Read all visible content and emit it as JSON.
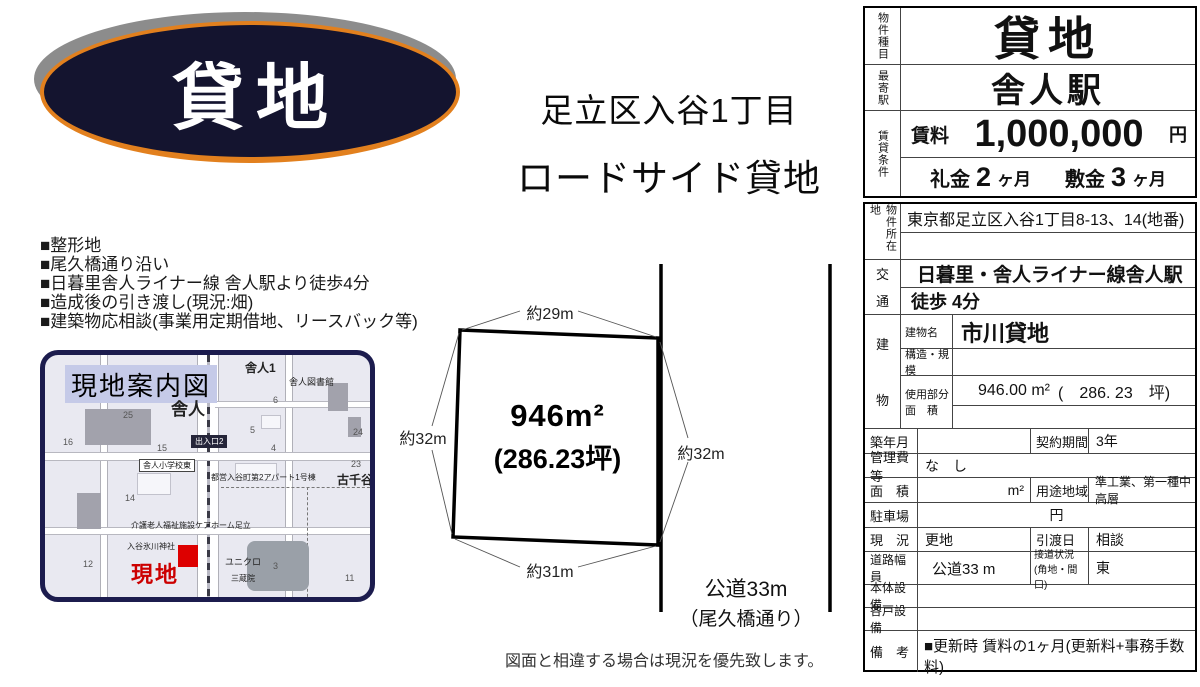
{
  "badge": {
    "label": "貸地"
  },
  "headline": {
    "line1": "足立区入谷1丁目",
    "line2": "ロードサイド貸地"
  },
  "features": [
    "■整形地",
    "■尾久橋通り沿い",
    "■日暮里舎人ライナー線 舎人駅より徒歩4分",
    "■造成後の引き渡し(現況:畑)",
    "■建築物応相談(事業用定期借地、リースバック等)"
  ],
  "map": {
    "title": "現地案内図",
    "site_label": "現地",
    "labels": {
      "town1": "舎人1",
      "library": "舎人図書館",
      "station": "舎人",
      "exit": "出入口2",
      "school_crossing": "舎人小学校東",
      "district": "古千谷",
      "apartment": "都営入谷町第2アパート1号棟",
      "care_home": "介護老人福祉施設ケアホーム足立",
      "shrine": "入谷氷川神社",
      "uniqlo": "ユニクロ",
      "temple": "三蔵院"
    },
    "numbers": [
      "25",
      "16",
      "15",
      "14",
      "5",
      "6",
      "4",
      "23",
      "24",
      "12",
      "11",
      "3"
    ]
  },
  "plot": {
    "area_m2": "946m²",
    "area_tsubo": "(286.23坪)",
    "dim_top": "約29m",
    "dim_left": "約32m",
    "dim_right": "約32m",
    "dim_bottom": "約31m",
    "road_line1": "公道33m",
    "road_line2": "（尾久橋通り）"
  },
  "note": "図面と相違する場合は現況を優先致します。",
  "table": {
    "property_type_label": "物件種目",
    "property_type": "貸地",
    "station_label": "最寄駅",
    "station": "舎人駅",
    "terms_label": "賃貸条件",
    "rent_label": "賃料",
    "rent_value": "1,000,000",
    "rent_unit": "円",
    "reikin_label": "礼金",
    "reikin_value": "2",
    "reikin_unit": "ヶ月",
    "shikikin_label": "敷金",
    "shikikin_value": "3",
    "shikikin_unit": "ヶ月",
    "location_label": "物件所在地",
    "address": "東京都足立区入谷1丁目8-13、14(地番)",
    "access_label_top": "交",
    "access_label_bottom": "通",
    "access_line1": "日暮里・舎人ライナー線舎人駅",
    "access_line2": "徒歩 4分",
    "building_label_top": "建",
    "building_label_bottom": "物",
    "building_name_label": "建物名",
    "building_name": "市川貸地",
    "structure_label": "構造・規模",
    "structure": "",
    "used_area_label1": "使用部分",
    "used_area_label2": "面　積",
    "used_area": "946.00 m²",
    "used_area_tsubo": "(　286. 23　坪)",
    "built_label": "築年月",
    "built": "",
    "contract_label": "契約期間",
    "contract": "3年",
    "mgmt_label": "管理費等",
    "mgmt": "な　し",
    "area_label": "面　積",
    "area_value": "m²",
    "zoning_label": "用途地域",
    "zoning": "準工業、第一種中高層",
    "parking_label": "駐車場",
    "parking": "円",
    "status_label": "現　況",
    "status": "更地",
    "handover_label": "引渡日",
    "handover": "相談",
    "road_label": "道路幅員",
    "road": "公道33 m",
    "frontage_label1": "接道状況",
    "frontage_label2": "(角地・間口)",
    "frontage": "東",
    "main_equip_label": "本体設備",
    "main_equip": "",
    "unit_equip_label": "各戸設備",
    "unit_equip": "",
    "remarks_label": "備　考",
    "remarks": "■更新時 賃料の1ヶ月(更新料+事務手数料)"
  }
}
